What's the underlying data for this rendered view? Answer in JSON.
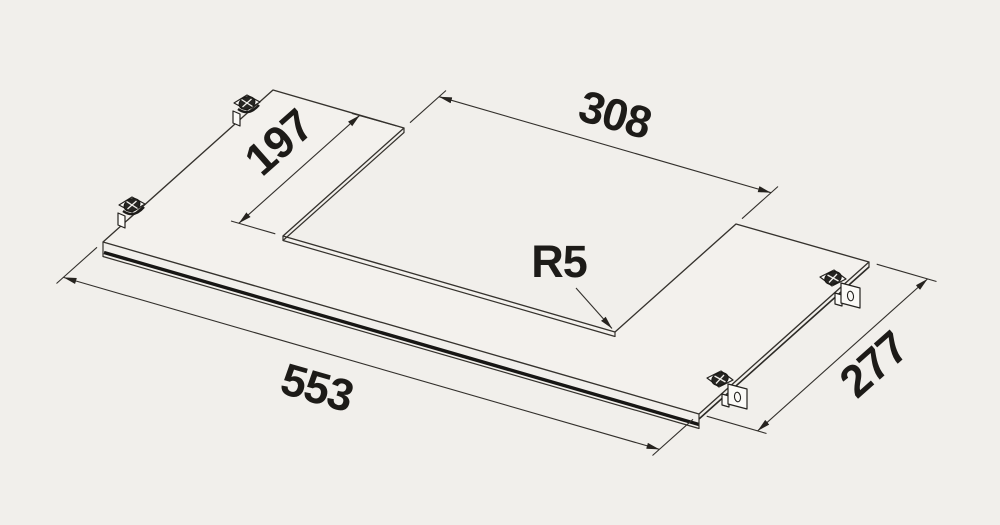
{
  "drawing": {
    "type": "isometric-dimension-drawing",
    "subject": "glass-panel-with-rectangular-cutout-and-mounting-clips",
    "labels": {
      "panel_length": "553",
      "panel_depth": "277",
      "cutout_width": "308",
      "cutout_depth": "197",
      "corner_radius": "R5"
    },
    "parts": {
      "mounting_clip_count": 4
    },
    "colors": {
      "background": "#f1efeb",
      "panel_fill": "#f3f1ed",
      "line": "#35322d",
      "edge_dark": "#171614",
      "text": "#1d1b18",
      "screw_dark": "#262522"
    }
  }
}
